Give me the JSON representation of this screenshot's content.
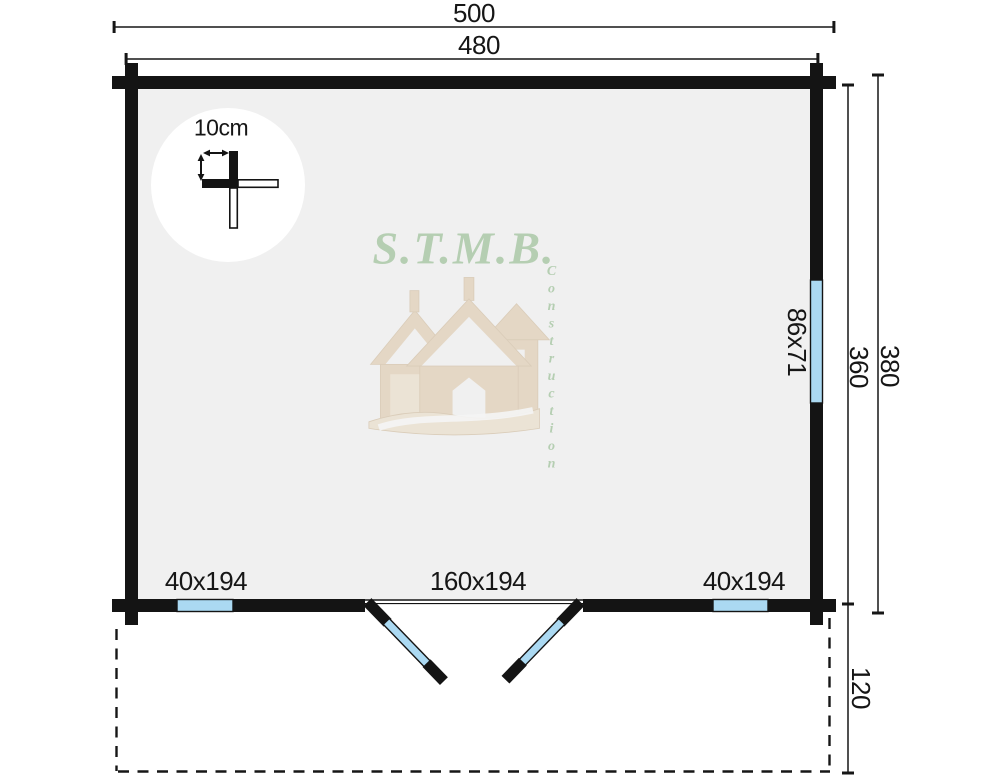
{
  "plan": {
    "dimensions": {
      "top_outer": "500",
      "top_inner": "480",
      "right_inner": "360",
      "right_outer": "380",
      "terrace_depth": "120"
    },
    "openings": {
      "side_window": "86x71",
      "bottom_left_window": "40x194",
      "double_door": "160x194",
      "bottom_right_window": "40x194"
    },
    "detail": {
      "wall_thickness": "10cm"
    },
    "watermark": {
      "brand": "S.T.M.B.",
      "subtitle": "Construction"
    },
    "colors": {
      "wall": "#141414",
      "floor": "#f0f0f0",
      "glass": "#abd9f2",
      "green": "#8fb98a",
      "wood": "#cfa873",
      "wood_light": "#e4cda3"
    }
  }
}
